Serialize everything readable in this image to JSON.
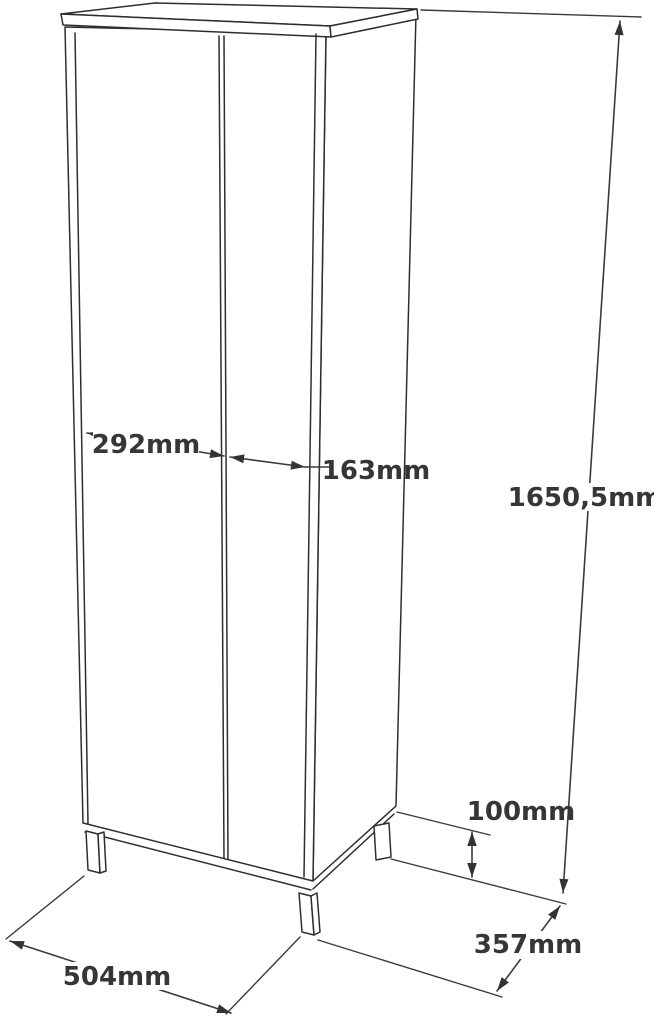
{
  "page": {
    "background_color": "#ffffff",
    "line_color": "#2e2e2e",
    "text_color": "#363636",
    "unit": "mm",
    "subject": "tall two-door cabinet technical dimension drawing"
  },
  "dimensions": {
    "left_door_width": {
      "label": "292mm",
      "value_mm": 292
    },
    "right_door_width": {
      "label": "163mm",
      "value_mm": 163
    },
    "total_height": {
      "label": "1650,5mm",
      "value_mm": 1650.5
    },
    "leg_height": {
      "label": "100mm",
      "value_mm": 100
    },
    "total_width": {
      "label": "504mm",
      "value_mm": 504
    },
    "total_depth": {
      "label": "357mm",
      "value_mm": 357
    }
  }
}
